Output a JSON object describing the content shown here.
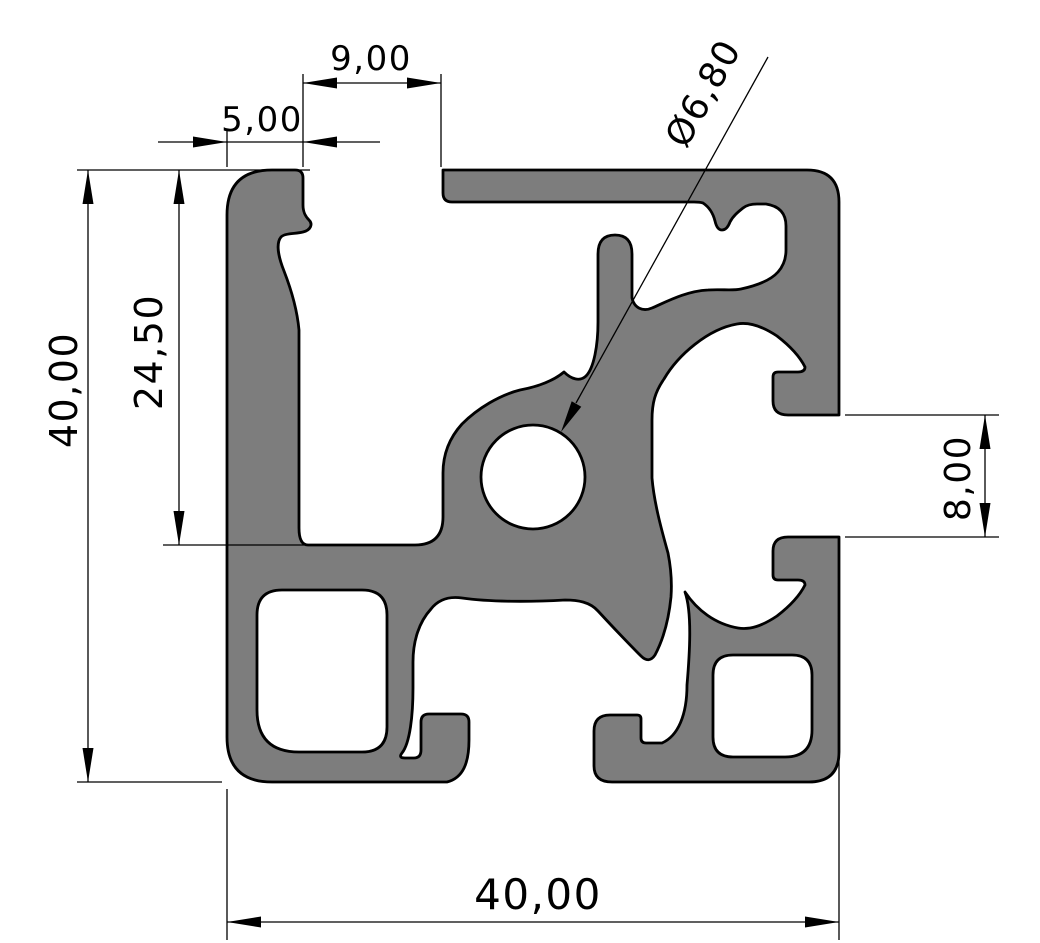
{
  "drawing": {
    "type": "technical-cross-section",
    "subject": "aluminium extrusion profile 40x40 with T-slots",
    "background": "#ffffff",
    "profile_fill": "#7d7d7d",
    "line_color": "#000000",
    "dimensions": {
      "top_slot_offset": "9,00",
      "lip_width": "5,00",
      "hole_diameter": "Ø6,80",
      "groove_height": "24,50",
      "overall_height": "40,00",
      "slot_opening": "8,00",
      "overall_width": "40,00"
    }
  }
}
